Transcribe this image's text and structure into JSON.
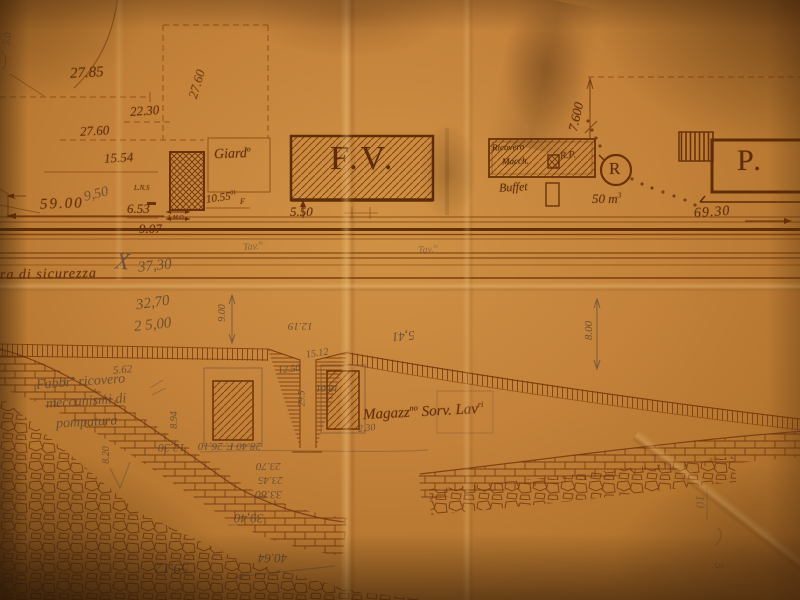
{
  "b": {
    "fv": "F.V.",
    "p": "P.",
    "giard": {
      "base": "Giard",
      "sup": "o"
    },
    "buffet": "Buffet",
    "rp": "R.P.",
    "res_letter": "R",
    "res_vol": {
      "base": "50 m",
      "sup": "3"
    },
    "ricovero": {
      "l1": "Ricovero",
      "l2": "Macch."
    },
    "sicurezza": "ra di sicurezza",
    "magazz": {
      "b1": "Magazz",
      "s1": "no",
      "b2": " Sorv. Lav",
      "s2": "ri"
    },
    "fabbr": {
      "l1a": "Fabbr",
      "l1s": "o",
      "l1b": " ricovero",
      "l2": "meccanismi di",
      "l3": "pompatura"
    },
    "f_mark": "F",
    "lns": "L.N.S",
    "lmo": "L.M.O"
  },
  "d": {
    "d2785": "27.85",
    "d2760r": "27.60",
    "d2230": "22.30",
    "d2760": "27.60",
    "d1554": "15.54",
    "d5900": "59.00",
    "d653": "6.53",
    "d907": "9.07",
    "d1055": {
      "base": "10.55",
      "sup": "01"
    },
    "d550": "5.50",
    "d7600": "7.600",
    "d6930": "69.30"
  },
  "n": {
    "x": "X",
    "p950": "9,50",
    "p3730": "37,30",
    "p3270": "32,70",
    "p2500": "2 5,00",
    "v900": "9.00",
    "v800": "8.00",
    "p562": "5.62",
    "p894": "8.94",
    "p820": "8.20",
    "p1230": "12.30",
    "p2840": "28.40 F. 26.10",
    "p2370": "23.70",
    "p2345": "23.45",
    "p3380": "33.80",
    "p3940": "39,40",
    "p5912": "59.12",
    "p4064": "40.64",
    "p1219": "12.19",
    "p1512": "15.12",
    "p1250": "12.50",
    "p1801": "18.01",
    "p295": "29.5",
    "p541": "5,41",
    "p230": "2.30",
    "tav1": {
      "base": "Tav.",
      "sup": "ta"
    },
    "tav2": {
      "base": "Tav.",
      "sup": "ta"
    },
    "p10": "10",
    "p5": "5",
    "p50": "5.0"
  },
  "colors": {
    "paper": "#c3813a",
    "ink": "#6b3208",
    "pencil": "#5e4836"
  }
}
